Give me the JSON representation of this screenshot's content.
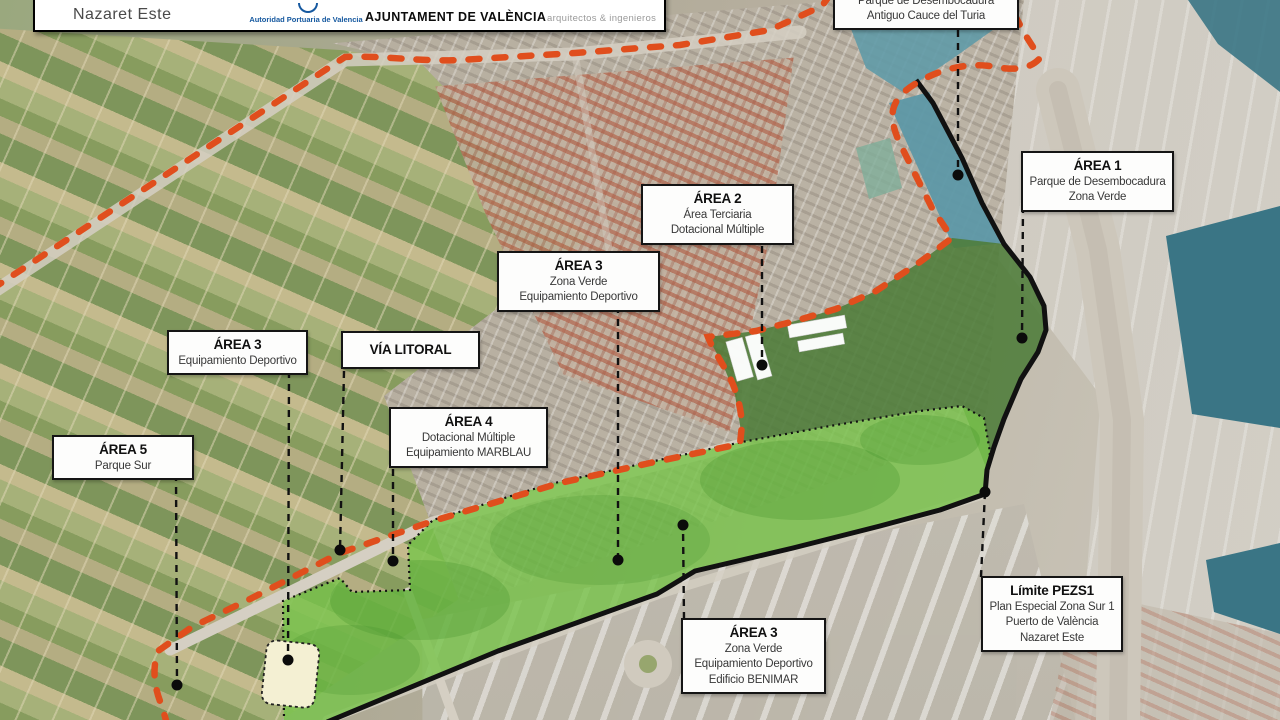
{
  "header": {
    "project": "Nazaret Este",
    "port_authority": "Autoridad Portuaria de Valencia",
    "city_council": "AJUNTAMENT DE VALÈNCIA",
    "studio": "arquitectos & ingenieros"
  },
  "colors": {
    "plan_boundary": "#e04e1d",
    "limit_line": "#111111",
    "park_green": "#79c34c",
    "riverbed_water": "#5d98a6",
    "harbor_water": "#3a7585",
    "building_highlight": "#f4f0d3"
  },
  "map": {
    "labels": [
      {
        "lines": [
          "Parque de Desembocadura",
          "Antiguo Cauce del Turia"
        ]
      },
      {
        "title": "ÁREA 1",
        "lines": [
          "Parque de Desembocadura",
          "Zona Verde"
        ]
      },
      {
        "title": "ÁREA 2",
        "lines": [
          "Área Terciaria",
          "Dotacional Múltiple"
        ]
      },
      {
        "title": "ÁREA 3",
        "lines": [
          "Zona Verde",
          "Equipamiento Deportivo"
        ]
      },
      {
        "title": "ÁREA 3",
        "lines": [
          "Equipamiento Deportivo"
        ]
      },
      {
        "title": "VÍA LITORAL",
        "lines": []
      },
      {
        "title": "ÁREA 4",
        "lines": [
          "Dotacional Múltiple",
          "Equipamiento MARBLAU"
        ]
      },
      {
        "title": "ÁREA 5",
        "lines": [
          "Parque Sur"
        ]
      },
      {
        "title": "ÁREA 3",
        "lines": [
          "Zona Verde",
          "Equipamiento Deportivo",
          "Edificio BENIMAR"
        ]
      },
      {
        "title": "Límite PEZS1",
        "lines": [
          "Plan Especial Zona Sur 1",
          "Puerto de València",
          "Nazaret Este"
        ]
      }
    ]
  }
}
